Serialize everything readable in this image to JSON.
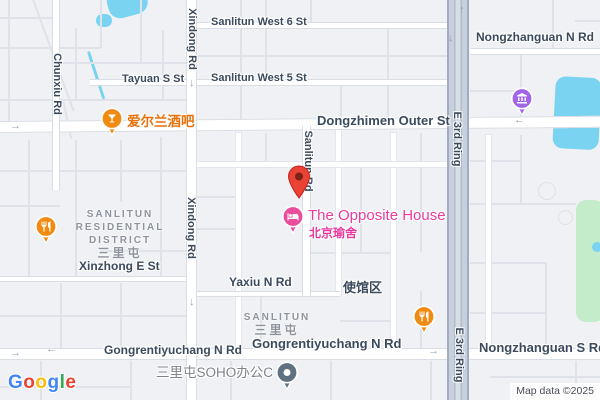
{
  "map": {
    "attribution": "Map data ©2025",
    "logo_letters": [
      {
        "ch": "G",
        "color": "#4285F4"
      },
      {
        "ch": "o",
        "color": "#EA4335"
      },
      {
        "ch": "o",
        "color": "#FBBC05"
      },
      {
        "ch": "g",
        "color": "#4285F4"
      },
      {
        "ch": "l",
        "color": "#34A853"
      },
      {
        "ch": "e",
        "color": "#EA4335"
      }
    ],
    "colors": {
      "background": "#f0f1f4",
      "water": "#7ad3f0",
      "park": "#c5ecca",
      "road_fill": "#ffffff",
      "road_casing": "#d9dee4",
      "ring_fill": "#c7d0dc",
      "ring_casing": "#9fadc0",
      "street_label": "#3b4a5c",
      "district_label": "#8d939d",
      "poi_orange": "#f18a10",
      "poi_pink": "#eb4d9d",
      "poi_purple": "#a166e8",
      "poi_slate": "#5f7181",
      "pin_red": "#EA4335",
      "pin_red_dark": "#7e2217",
      "orange_text": "#e8710a",
      "pink_text": "#ea3a9e",
      "soho_text": "#7d838c"
    },
    "parks": [
      {
        "x": 576,
        "y": 200,
        "w": 28,
        "h": 122,
        "r": 10
      }
    ],
    "water": [
      {
        "x": 104,
        "y": -8,
        "w": 40,
        "h": 30,
        "r": 12,
        "rot": -15
      },
      {
        "x": 96,
        "y": 14,
        "w": 16,
        "h": 13,
        "r": 7
      },
      {
        "x": 87,
        "y": 52,
        "w": 3,
        "h": 50,
        "r": 2,
        "rot": -18
      },
      {
        "x": 556,
        "y": 76,
        "w": 46,
        "h": 72,
        "r": 10,
        "rot": 3
      },
      {
        "x": 592,
        "y": 242,
        "w": 10,
        "h": 10,
        "r": 5
      }
    ],
    "path_circles": [
      {
        "x": 538,
        "y": 182,
        "w": 18,
        "h": 18
      },
      {
        "x": 558,
        "y": 210,
        "w": 15,
        "h": 15
      }
    ],
    "minor_roads": [
      {
        "x": 8,
        "y": 0,
        "w": 2,
        "h": 122
      },
      {
        "x": 0,
        "y": 17,
        "w": 53,
        "h": 2
      },
      {
        "x": 0,
        "y": 47,
        "w": 100,
        "h": 2
      },
      {
        "x": 60,
        "y": 62,
        "w": 126,
        "h": 2
      },
      {
        "x": 0,
        "y": 99,
        "w": 186,
        "h": 2
      },
      {
        "x": 75,
        "y": 28,
        "w": 2,
        "h": 72
      },
      {
        "x": 100,
        "y": 0,
        "w": 2,
        "h": 48
      },
      {
        "x": 140,
        "y": 0,
        "w": 2,
        "h": 62
      },
      {
        "x": 162,
        "y": 30,
        "w": 2,
        "h": 70
      },
      {
        "x": 30,
        "y": -6,
        "w": 2,
        "h": 125,
        "rot": -20
      },
      {
        "x": 62,
        "y": 100,
        "w": 2,
        "h": 40,
        "rot": -12
      },
      {
        "x": 28,
        "y": 140,
        "w": 2,
        "h": 137
      },
      {
        "x": 75,
        "y": 140,
        "w": 2,
        "h": 137
      },
      {
        "x": 120,
        "y": 140,
        "w": 2,
        "h": 62
      },
      {
        "x": 160,
        "y": 137,
        "w": 2,
        "h": 140
      },
      {
        "x": 0,
        "y": 170,
        "w": 186,
        "h": 2
      },
      {
        "x": 0,
        "y": 205,
        "w": 60,
        "h": 2
      },
      {
        "x": 100,
        "y": 250,
        "w": 86,
        "h": 2
      },
      {
        "x": 60,
        "y": 283,
        "w": 2,
        "h": 65
      },
      {
        "x": 120,
        "y": 283,
        "w": 2,
        "h": 65
      },
      {
        "x": 0,
        "y": 315,
        "w": 186,
        "h": 2
      },
      {
        "x": 240,
        "y": 0,
        "w": 2,
        "h": 121
      },
      {
        "x": 265,
        "y": 0,
        "w": 2,
        "h": 79
      },
      {
        "x": 310,
        "y": 0,
        "w": 2,
        "h": 22
      },
      {
        "x": 387,
        "y": 29,
        "w": 2,
        "h": 92
      },
      {
        "x": 197,
        "y": 55,
        "w": 250,
        "h": 2
      },
      {
        "x": 340,
        "y": 86,
        "w": 2,
        "h": 35
      },
      {
        "x": 265,
        "y": 133,
        "w": 2,
        "h": 32
      },
      {
        "x": 360,
        "y": 165,
        "w": 2,
        "h": 87
      },
      {
        "x": 420,
        "y": 133,
        "w": 2,
        "h": 119
      },
      {
        "x": 197,
        "y": 196,
        "w": 41,
        "h": 2
      },
      {
        "x": 311,
        "y": 252,
        "w": 82,
        "h": 2
      },
      {
        "x": 197,
        "y": 228,
        "w": 41,
        "h": 2
      },
      {
        "x": 260,
        "y": 297,
        "w": 2,
        "h": 51
      },
      {
        "x": 420,
        "y": 291,
        "w": 2,
        "h": 57
      },
      {
        "x": 340,
        "y": 320,
        "w": 53,
        "h": 2
      },
      {
        "x": 520,
        "y": 55,
        "w": 2,
        "h": 66
      },
      {
        "x": 552,
        "y": 0,
        "w": 2,
        "h": 49
      },
      {
        "x": 575,
        "y": 20,
        "w": 25,
        "h": 2
      },
      {
        "x": 470,
        "y": 90,
        "w": 50,
        "h": 2
      },
      {
        "x": 520,
        "y": 135,
        "w": 2,
        "h": 68
      },
      {
        "x": 470,
        "y": 160,
        "w": 50,
        "h": 2
      },
      {
        "x": 470,
        "y": 203,
        "w": 106,
        "h": 2
      },
      {
        "x": 470,
        "y": 262,
        "w": 75,
        "h": 2
      },
      {
        "x": 545,
        "y": 262,
        "w": 2,
        "h": 86
      },
      {
        "x": 470,
        "y": 312,
        "w": 75,
        "h": 2
      },
      {
        "x": 40,
        "y": 361,
        "w": 2,
        "h": 39
      },
      {
        "x": 130,
        "y": 361,
        "w": 2,
        "h": 39
      },
      {
        "x": 230,
        "y": 361,
        "w": 2,
        "h": 39
      },
      {
        "x": 330,
        "y": 361,
        "w": 2,
        "h": 39
      },
      {
        "x": 430,
        "y": 361,
        "w": 2,
        "h": 39
      },
      {
        "x": 0,
        "y": 386,
        "w": 130,
        "h": 2
      },
      {
        "x": 490,
        "y": 376,
        "w": 110,
        "h": 2
      },
      {
        "x": 575,
        "y": 361,
        "w": 2,
        "h": 39
      }
    ],
    "mid_roads": [
      {
        "x": 236,
        "y": 133,
        "w": 5,
        "h": 215
      },
      {
        "x": 391,
        "y": 133,
        "w": 5,
        "h": 215
      },
      {
        "x": 336,
        "y": 128,
        "w": 5,
        "h": 166
      },
      {
        "x": 486,
        "y": 135,
        "w": 5,
        "h": 213
      },
      {
        "x": 197,
        "y": 162,
        "w": 250,
        "h": 5
      }
    ],
    "major_roads": [
      {
        "x": 0,
        "y": 121,
        "w": 600,
        "h": 12,
        "rot": -0.5
      },
      {
        "x": 0,
        "y": 348,
        "w": 600,
        "h": 12
      },
      {
        "x": 193,
        "y": 22,
        "w": 260,
        "h": 7
      },
      {
        "x": 90,
        "y": 79,
        "w": 362,
        "h": 7
      },
      {
        "x": 470,
        "y": 48,
        "w": 130,
        "h": 7
      },
      {
        "x": 0,
        "y": 276,
        "w": 192,
        "h": 6
      },
      {
        "x": 190,
        "y": 291,
        "w": 150,
        "h": 6
      },
      {
        "x": 186,
        "y": 0,
        "w": 11,
        "h": 400
      },
      {
        "x": 302,
        "y": 126,
        "w": 9,
        "h": 170
      },
      {
        "x": 52,
        "y": 0,
        "w": 8,
        "h": 190
      }
    ],
    "ring_road": {
      "x": 447,
      "y": 0,
      "w": 22,
      "h": 400
    },
    "arrows": [
      {
        "name": "right-arrow-icon",
        "glyph": "→",
        "x": 10,
        "y": 121
      },
      {
        "name": "left-arrow-icon",
        "glyph": "←",
        "x": 514,
        "y": 115
      },
      {
        "name": "right-arrow-icon",
        "glyph": "→",
        "x": 10,
        "y": 348
      },
      {
        "name": "left-arrow-icon",
        "glyph": "←",
        "x": 46,
        "y": 344
      },
      {
        "name": "right-arrow-icon",
        "glyph": "→",
        "x": 428,
        "y": 346
      },
      {
        "name": "down-arrow-icon",
        "glyph": "↓",
        "x": 189,
        "y": 78
      },
      {
        "name": "down-arrow-icon",
        "glyph": "↓",
        "x": 189,
        "y": 297
      },
      {
        "name": "up-arrow-icon",
        "glyph": "↑",
        "x": 459,
        "y": 5
      },
      {
        "name": "down-arrow-icon",
        "glyph": "↓",
        "x": 448,
        "y": 33
      }
    ],
    "street_labels": [
      {
        "text": "Sanlitun West 6 St",
        "x": 211,
        "y": 16,
        "size": 11
      },
      {
        "text": "Tayuan S St",
        "x": 122,
        "y": 73,
        "size": 11
      },
      {
        "text": "Sanlitun West 5 St",
        "x": 211,
        "y": 72,
        "size": 11
      },
      {
        "text": "Nongzhanguan N Rd",
        "x": 476,
        "y": 30,
        "size": 12
      },
      {
        "text": "Dongzhimen Outer St",
        "x": 317,
        "y": 113,
        "size": 13
      },
      {
        "text": "Xinzhong E St",
        "x": 79,
        "y": 259,
        "size": 12
      },
      {
        "text": "Yaxiu N Rd",
        "x": 229,
        "y": 275,
        "size": 12
      },
      {
        "text": "使馆区",
        "x": 343,
        "y": 277,
        "size": 13
      },
      {
        "text": "Gongrentiyuchang N Rd",
        "x": 104,
        "y": 343,
        "size": 12
      },
      {
        "text": "Gongrentiyuchang N Rd",
        "x": 252,
        "y": 336,
        "size": 13
      },
      {
        "text": "Nongzhanguan S Rd",
        "x": 479,
        "y": 340,
        "size": 13
      },
      {
        "text": "三里屯SOHO办公C",
        "x": 156,
        "y": 361,
        "size": 13.5,
        "muted": true
      }
    ],
    "vertical_labels": [
      {
        "text": "Chunxiu Rd",
        "cx": 57,
        "cy": 84
      },
      {
        "text": "Xindong Rd",
        "cx": 192,
        "cy": 39
      },
      {
        "text": "Xindong Rd",
        "cx": 191,
        "cy": 228
      },
      {
        "text": "Sanlitun Rd",
        "cx": 308,
        "cy": 161
      },
      {
        "text": "E 3rd Ring",
        "cx": 457,
        "cy": 139
      },
      {
        "text": "E 3rd Ring",
        "cx": 459,
        "cy": 355
      }
    ],
    "district_labels": [
      {
        "lines": [
          "SANLITUN",
          "RESIDENTIAL",
          "DISTRICT"
        ],
        "cjk": "三里屯",
        "cx": 120,
        "y": 208
      },
      {
        "lines": [
          "SANLITUN"
        ],
        "cjk": "三里屯",
        "cx": 277,
        "y": 311
      }
    ],
    "pois": [
      {
        "type": "bar",
        "x": 112,
        "y": 119,
        "color": "#f18a10"
      },
      {
        "type": "restaurant",
        "x": 46,
        "y": 227,
        "color": "#f18a10"
      },
      {
        "type": "restaurant",
        "x": 424,
        "y": 317,
        "color": "#f18a10"
      },
      {
        "type": "hotel",
        "x": 293,
        "y": 217,
        "color": "#eb4d9d"
      },
      {
        "type": "museum",
        "x": 522,
        "y": 99,
        "color": "#a166e8"
      },
      {
        "type": "place",
        "x": 287,
        "y": 373,
        "color": "#5f7181"
      }
    ],
    "poi_labels": [
      {
        "text": "爱尔兰酒吧",
        "x": 127,
        "y": 110,
        "color": "#e8710a",
        "size": 13.5,
        "bold": true
      },
      {
        "text": "The Opposite House",
        "x": 308,
        "y": 207,
        "color": "#ea3a9e",
        "size": 15,
        "bold": false
      },
      {
        "text": "北京瑜舍",
        "x": 309,
        "y": 224,
        "color": "#ea3a9e",
        "size": 12,
        "bold": true
      }
    ],
    "pin": {
      "x": 299,
      "y": 199
    }
  }
}
